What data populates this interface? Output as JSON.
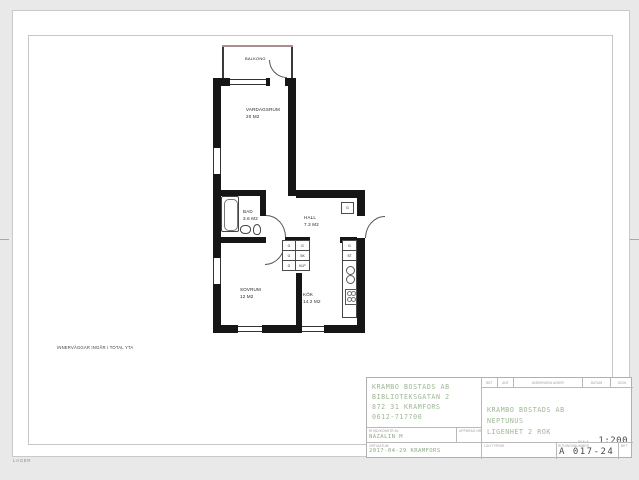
{
  "page": {
    "ref_label": "REF",
    "lager_label": "LAGER"
  },
  "plan": {
    "note": "INNERVÄGGAR INGÅR I TOTAL YTA",
    "rooms": {
      "balkong": {
        "name": "BALKONG",
        "area": ""
      },
      "vardagsrum": {
        "name": "VARDAGSRUM",
        "area": "20 M2"
      },
      "bad": {
        "name": "BAD",
        "area": "3.6 M2"
      },
      "hall": {
        "name": "HALL",
        "area": "7.3 M2"
      },
      "sovrum": {
        "name": "SOVRUM",
        "area": "12 M2"
      },
      "kok": {
        "name": "KÖK",
        "area": "14.2 M2"
      }
    },
    "closets": {
      "bedroom": [
        "G",
        "G",
        "G"
      ],
      "hall_col": [
        "G",
        "SK",
        "KLP"
      ],
      "hall_single": "G",
      "kitchen": [
        "G",
        "ST"
      ]
    }
  },
  "title_block": {
    "company": {
      "line1": "KRAMBO BOSTADS AB",
      "line2": "BIBLIOTEKSGATAN 2",
      "line3": "872 31 KRAMFORS",
      "line4": "0612-717700"
    },
    "drawn_by_label": "RITAD/KONSTR AV",
    "drawn_by": "NAZALIN M",
    "assignment_label": "UPPDRAG NR",
    "place_date_label": "ORT/DATUM",
    "place_date": "2017-04-29 KRAMFORS",
    "rev_headers": [
      "BET",
      "ANT",
      "ÄNDRINGEN AVSER",
      "DATUM",
      "SIGN"
    ],
    "project": {
      "line1": "KRAMBO BOSTADS AB",
      "line2": "NEPTUNUS",
      "line3": "LIGENHET 2 ROK"
    },
    "scale_label": "SKALA",
    "scale_value": "1:200",
    "type_label": "LGH TYP/NR",
    "number_label": "RITNINGSNUMMER",
    "number_value": "A 017-24",
    "bet_label": "BET"
  },
  "colors": {
    "accent_green": "#9cb894",
    "wall": "#161616",
    "balcony_line": "#a98f8f"
  }
}
